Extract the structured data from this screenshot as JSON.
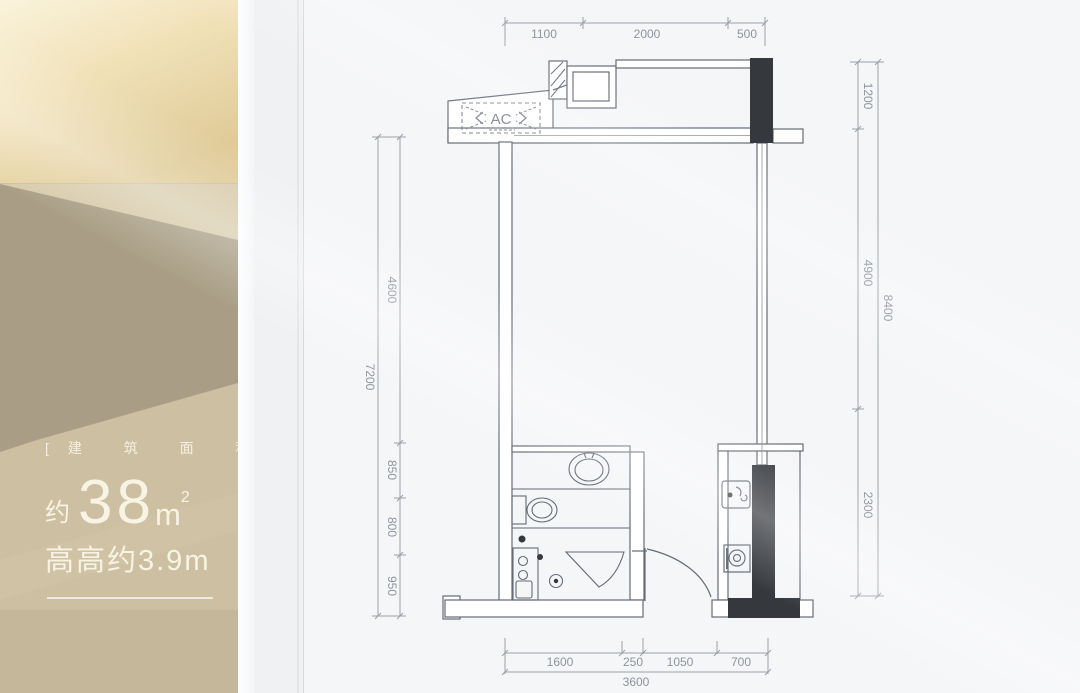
{
  "panel": {
    "area_label": "[建 筑 面 积]",
    "area_prefix": "约",
    "area_value": "38",
    "area_unit": "m",
    "area_sup": "2",
    "height_text": "高高约3.9m",
    "bg_top": "#f8f0d6",
    "bg_mid": "#cdc0a2",
    "bg_dark": "#a99e85",
    "text_color": "#f8f3e3"
  },
  "plan": {
    "ac_label": "AC",
    "dimensions": {
      "top": [
        "1100",
        "2000",
        "500"
      ],
      "left_outer": "7200",
      "left_inner": [
        "4600",
        "850",
        "800",
        "950"
      ],
      "right_inner": [
        "1200",
        "4900",
        "2300"
      ],
      "right_outer": "8400",
      "bottom_inner": [
        "1600",
        "250",
        "1050",
        "700"
      ],
      "bottom_outer": "3600"
    },
    "line_color": "#646b75",
    "dim_color": "#8e949c",
    "column_color": "#35383d",
    "page_bg": "#f5f6f8"
  }
}
